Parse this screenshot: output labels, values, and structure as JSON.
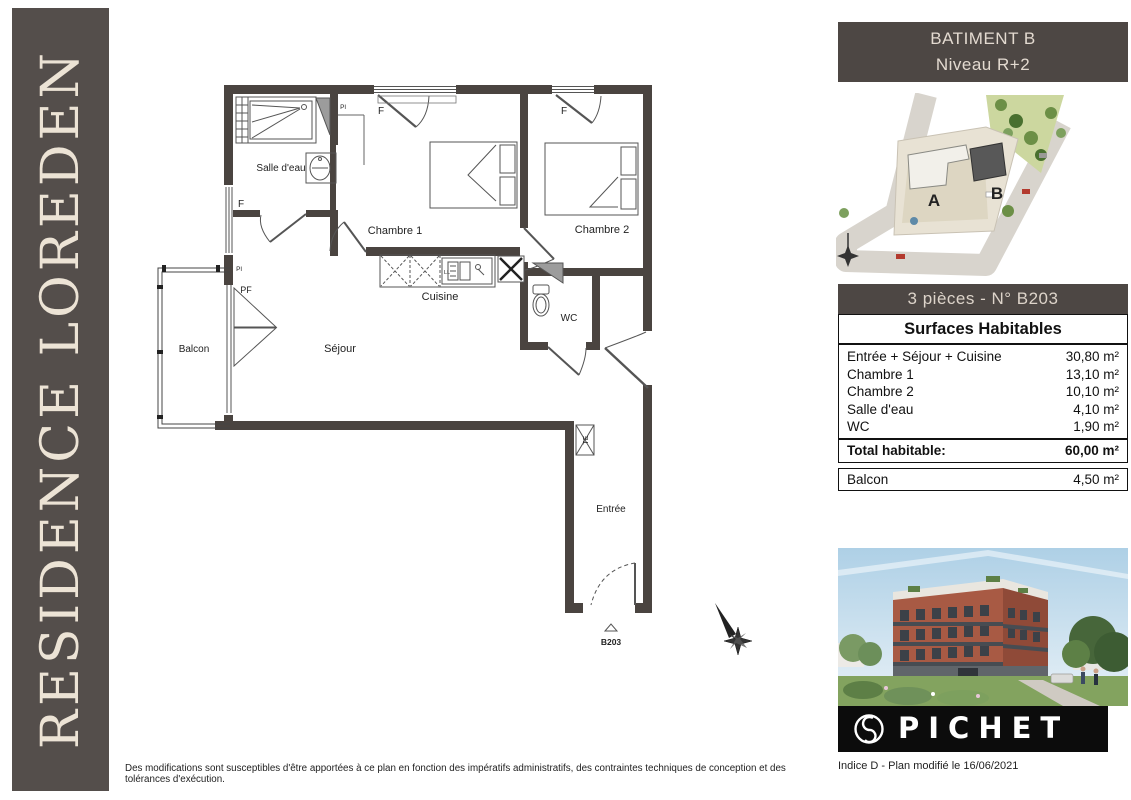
{
  "banner": {
    "title": "RESIDENCE LOREDEN"
  },
  "plan": {
    "rooms": {
      "bathroom": "Salle d'eau",
      "bedroom1": "Chambre 1",
      "bedroom2": "Chambre 2",
      "kitchen": "Cuisine",
      "wc": "WC",
      "living": "Séjour",
      "balcony": "Balcon",
      "entry": "Entrée"
    },
    "labels": {
      "window": "F",
      "french_door": "PF",
      "closet": "Pl",
      "technical": "TE",
      "washer": "LL",
      "unit_number": "B203"
    },
    "scale_bar": {
      "tick0": "0",
      "tick1": "1",
      "tick2": "2m"
    }
  },
  "sidebar": {
    "building_header": {
      "line1": "BATIMENT B",
      "line2": "Niveau R+2"
    },
    "site_plan": {
      "building_a": "A",
      "building_b": "B"
    },
    "unit_header": "3 pièces  - N° B203",
    "surfaces": {
      "title": "Surfaces Habitables",
      "rows": [
        {
          "label": "Entrée + Séjour + Cuisine",
          "value": "30,80 m²"
        },
        {
          "label": "Chambre 1",
          "value": "13,10 m²"
        },
        {
          "label": "Chambre 2",
          "value": "10,10 m²"
        },
        {
          "label": "Salle d'eau",
          "value": "4,10 m²"
        },
        {
          "label": "WC",
          "value": "1,90 m²"
        }
      ],
      "total_label": "Total habitable:",
      "total_value": "60,00 m²"
    },
    "balcony": {
      "label": "Balcon",
      "value": "4,50 m²"
    },
    "brand": {
      "name": "PICHET"
    },
    "revision": "Indice D - Plan modifié  le 16/06/2021"
  },
  "footer": {
    "disclaimer": "Des modifications sont susceptibles d'être apportées à ce plan en fonction des impératifs administratifs, des contraintes techniques de conception et des tolérances d'exécution."
  },
  "colors": {
    "banner_bg": "#544e4b",
    "header_bg": "#4d4744",
    "wall": "#4a4440",
    "logo_bg": "#0c0c0c"
  }
}
